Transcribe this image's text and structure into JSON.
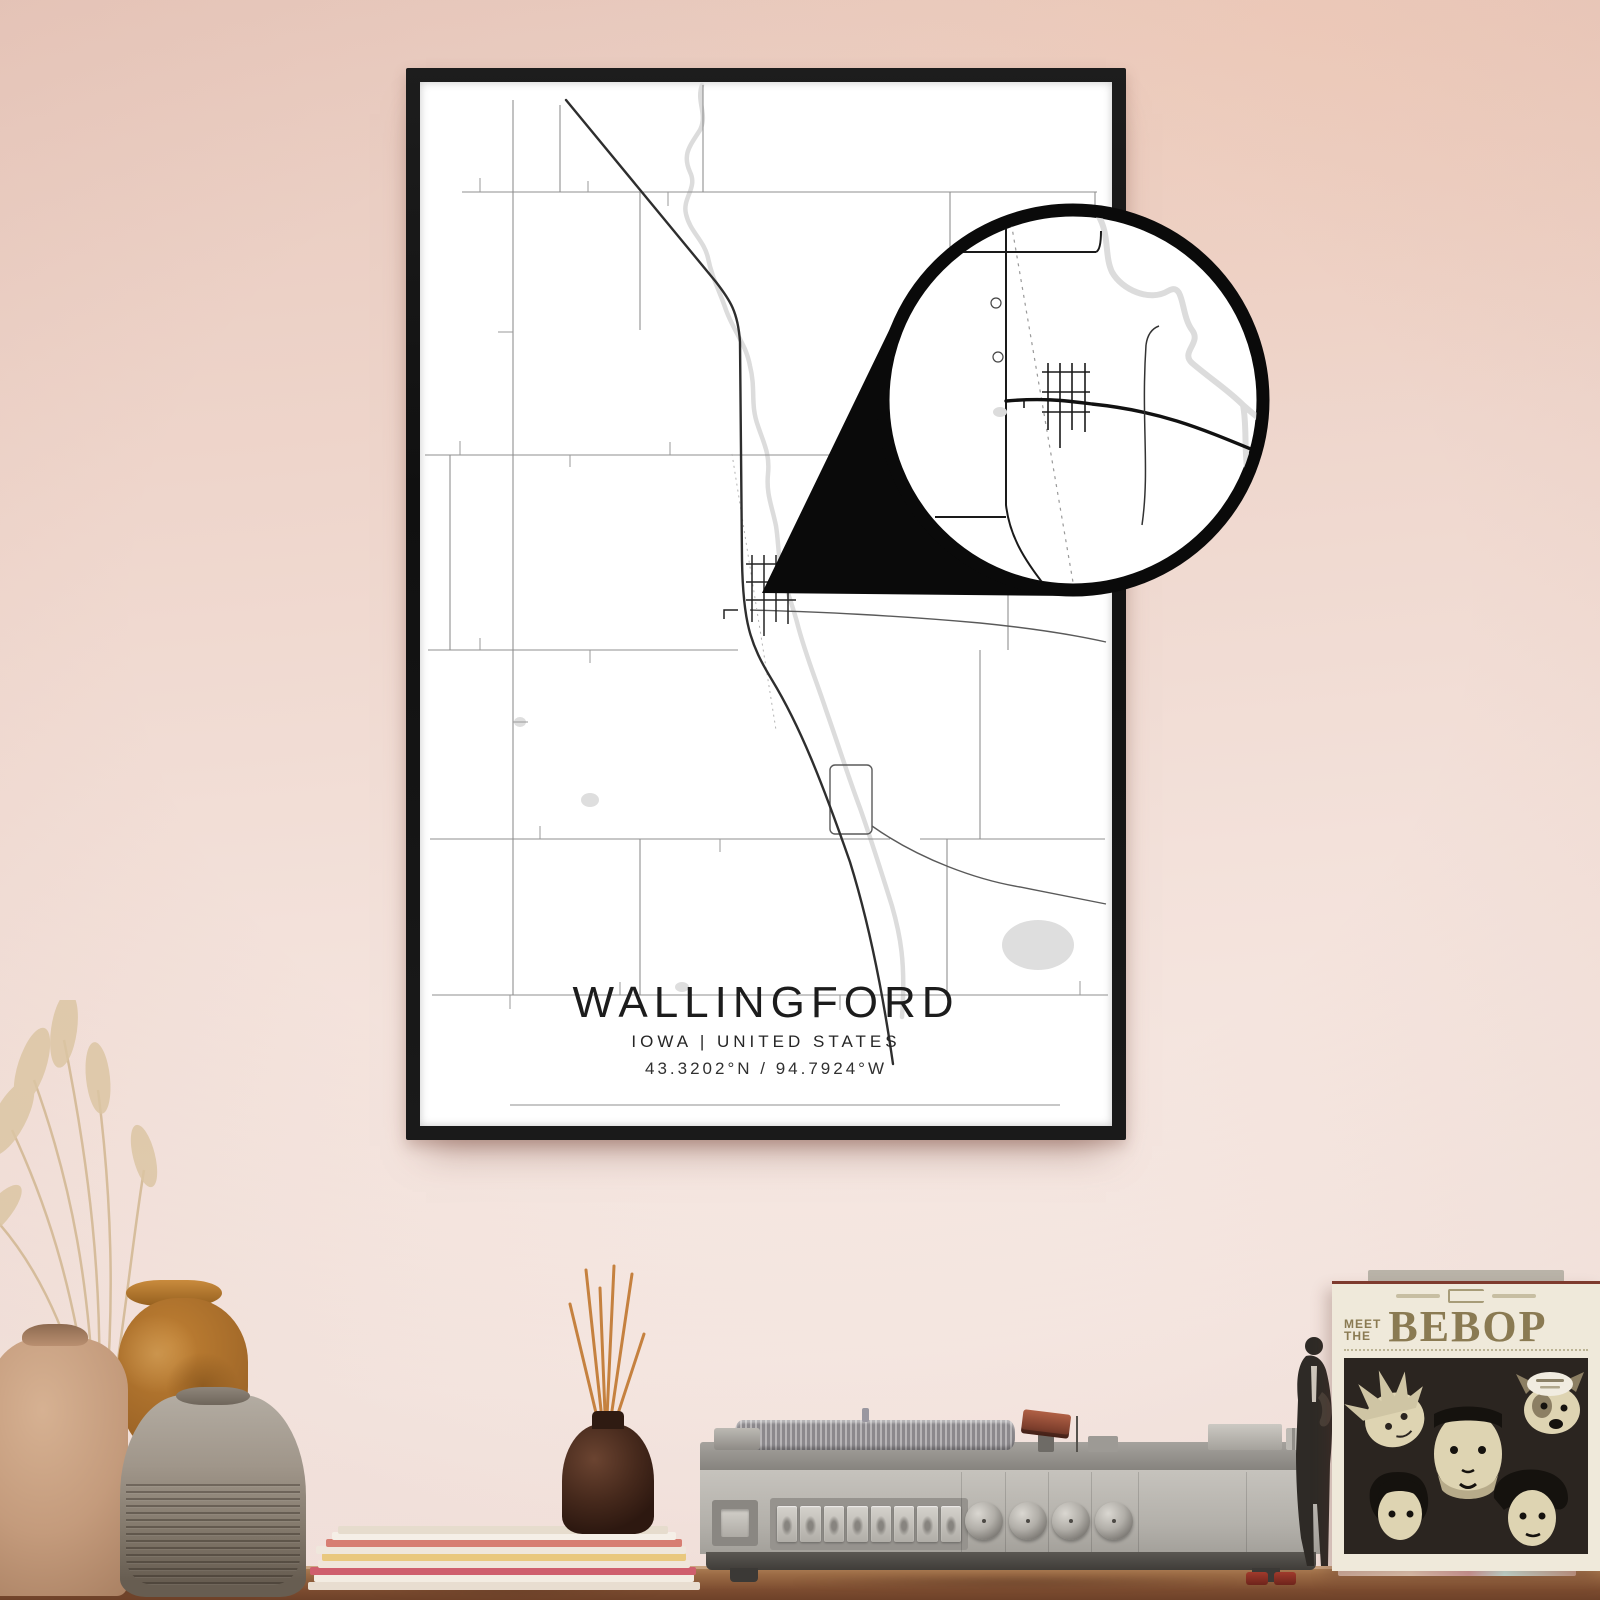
{
  "poster": {
    "title": "WALLINGFORD",
    "subtitle": "IOWA | UNITED STATES",
    "coordinates": "43.3202°N / 94.7924°W"
  },
  "record_sleeve": {
    "label_meet": "MEET",
    "label_the": "THE",
    "title": "BEBOP"
  },
  "colors": {
    "wall_top": "#e8c9bd",
    "wall_bottom": "#f7ebe6",
    "frame": "#161616",
    "poster_bg": "#ffffff",
    "road": "#3a3a3a",
    "road_minor": "#8f8f8f",
    "water": "#dcdcdc",
    "wood": "#95664a",
    "player_body": "#b9b6b0",
    "sleeve_band": "#e9e2cd",
    "sleeve_text": "#8a7a52",
    "sleeve_art_bg": "#2b2520",
    "reed": "#c5813f",
    "vase_tan": "#c49b7c",
    "vase_orange": "#b0702c",
    "vase_gray": "#9c9287",
    "diffuser": "#46291c"
  }
}
